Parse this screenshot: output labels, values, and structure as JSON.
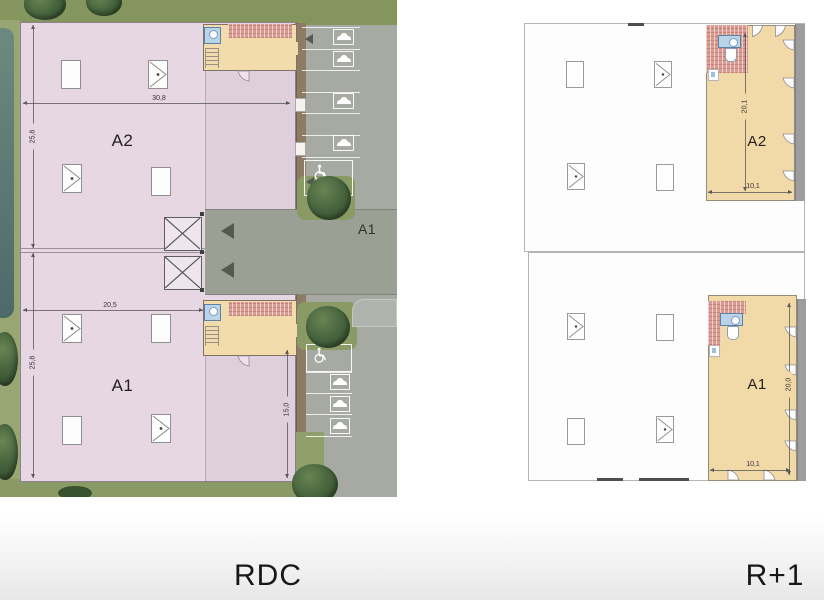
{
  "rdc": {
    "title": "RDC",
    "building": {
      "a2": {
        "label": "A2",
        "width_dim": "30,8",
        "height_dim": "25,8"
      },
      "a1": {
        "label": "A1",
        "width_dim": "20,5",
        "height_dim": "25,8",
        "wing_height_dim": "15,0"
      }
    },
    "parking": {
      "zone_label": "A1"
    },
    "colors": {
      "building_fill": "#e7d7e3",
      "mezzanine_fill": "#f3dcab",
      "pavement": "#a7aaa2",
      "grass": "#8c9c66",
      "water": "#597876",
      "tree_foliage": "#42603a",
      "stair_hatch": "#d79c92"
    }
  },
  "r1": {
    "title": "R+1",
    "units": {
      "a2": {
        "label": "A2",
        "height_dim": "20,1",
        "width_dim": "10,1"
      },
      "a1": {
        "label": "A1",
        "height_dim": "20,0",
        "width_dim": "10,1"
      }
    },
    "colors": {
      "floor_fill": "#fdfdfd",
      "mezzanine_fill": "#f2d9a8",
      "outline": "#b5b5b5",
      "walkway": "#9d9d9d"
    }
  }
}
